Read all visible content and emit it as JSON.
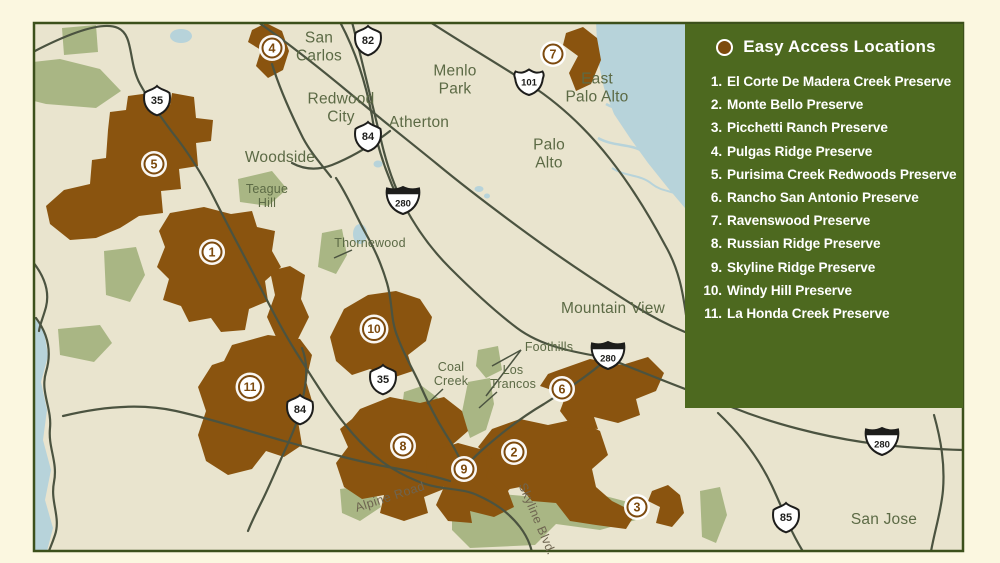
{
  "palette": {
    "page_bg": "#fbf7e0",
    "map_bg": "#e9e4ce",
    "map_border": "#3c501b",
    "preserve_brown": "#8a540f",
    "open_space_green": "#a9b684",
    "water_blue": "#b7d3da",
    "road": "#4b5340",
    "legend_green": "#4d691f",
    "marker_brown": "#7c4a0e",
    "label_olive": "#5c6a45"
  },
  "legend": {
    "title": "Easy Access Locations",
    "dot_icon": "easy-access-location-dot",
    "items": [
      {
        "number": "1.",
        "name": "El Corte De Madera Creek Preserve"
      },
      {
        "number": "2.",
        "name": "Monte Bello Preserve"
      },
      {
        "number": "3.",
        "name": "Picchetti Ranch Preserve"
      },
      {
        "number": "4.",
        "name": "Pulgas Ridge Preserve"
      },
      {
        "number": "5.",
        "name": "Purisima Creek Redwoods Preserve"
      },
      {
        "number": "6.",
        "name": "Rancho San Antonio Preserve"
      },
      {
        "number": "7.",
        "name": "Ravenswood Preserve"
      },
      {
        "number": "8.",
        "name": "Russian Ridge Preserve"
      },
      {
        "number": "9.",
        "name": "Skyline Ridge Preserve"
      },
      {
        "number": "10.",
        "name": "Windy Hill Preserve"
      },
      {
        "number": "11.",
        "name": "La Honda Creek Preserve"
      }
    ]
  },
  "map": {
    "city_labels": [
      {
        "lines": [
          "San",
          "Carlos"
        ],
        "x": 319,
        "y": 47
      },
      {
        "lines": [
          "Redwood",
          "City"
        ],
        "x": 341,
        "y": 108
      },
      {
        "lines": [
          "Menlo",
          "Park"
        ],
        "x": 455,
        "y": 80
      },
      {
        "lines": [
          "Atherton"
        ],
        "x": 419,
        "y": 123
      },
      {
        "lines": [
          "East",
          "Palo Alto"
        ],
        "x": 597,
        "y": 88
      },
      {
        "lines": [
          "Palo",
          "Alto"
        ],
        "x": 549,
        "y": 154
      },
      {
        "lines": [
          "Woodside"
        ],
        "x": 280,
        "y": 158
      },
      {
        "lines": [
          "Mountain View"
        ],
        "x": 613,
        "y": 309
      },
      {
        "lines": [
          "San Jose"
        ],
        "x": 884,
        "y": 520
      }
    ],
    "feature_labels": [
      {
        "lines": [
          "Teague",
          "Hill"
        ],
        "x": 267,
        "y": 196
      },
      {
        "lines": [
          "Thornewood"
        ],
        "x": 370,
        "y": 243
      },
      {
        "lines": [
          "Coal",
          "Creek"
        ],
        "x": 451,
        "y": 374
      },
      {
        "lines": [
          "Los",
          "Trancos"
        ],
        "x": 513,
        "y": 377
      },
      {
        "lines": [
          "Foothills"
        ],
        "x": 549,
        "y": 347
      }
    ],
    "road_labels": [
      {
        "text": "Alpine Road",
        "x": 390,
        "y": 497,
        "angle": -18
      },
      {
        "text": "Skyline Blvd.",
        "x": 537,
        "y": 519,
        "angle": 67
      }
    ],
    "shields": [
      {
        "type": "state",
        "number": "35",
        "x": 157,
        "y": 103
      },
      {
        "type": "state",
        "number": "82",
        "x": 368,
        "y": 43
      },
      {
        "type": "us",
        "number": "101",
        "x": 529,
        "y": 84
      },
      {
        "type": "state",
        "number": "84",
        "x": 368,
        "y": 139
      },
      {
        "type": "interstate",
        "number": "280",
        "x": 403,
        "y": 203
      },
      {
        "type": "interstate",
        "number": "280",
        "x": 608,
        "y": 358
      },
      {
        "type": "state",
        "number": "35",
        "x": 383,
        "y": 382
      },
      {
        "type": "state",
        "number": "84",
        "x": 300,
        "y": 412
      },
      {
        "type": "interstate",
        "number": "280",
        "x": 882,
        "y": 444
      },
      {
        "type": "state",
        "number": "85",
        "x": 786,
        "y": 520
      }
    ],
    "markers": [
      {
        "number": "1",
        "x": 212,
        "y": 252
      },
      {
        "number": "2",
        "x": 514,
        "y": 452
      },
      {
        "number": "3",
        "x": 637,
        "y": 507
      },
      {
        "number": "4",
        "x": 272,
        "y": 48
      },
      {
        "number": "5",
        "x": 154,
        "y": 164
      },
      {
        "number": "6",
        "x": 562,
        "y": 389
      },
      {
        "number": "7",
        "x": 553,
        "y": 54
      },
      {
        "number": "8",
        "x": 403,
        "y": 446
      },
      {
        "number": "9",
        "x": 464,
        "y": 469
      },
      {
        "number": "10",
        "x": 374,
        "y": 329
      },
      {
        "number": "11",
        "x": 250,
        "y": 387
      }
    ]
  }
}
